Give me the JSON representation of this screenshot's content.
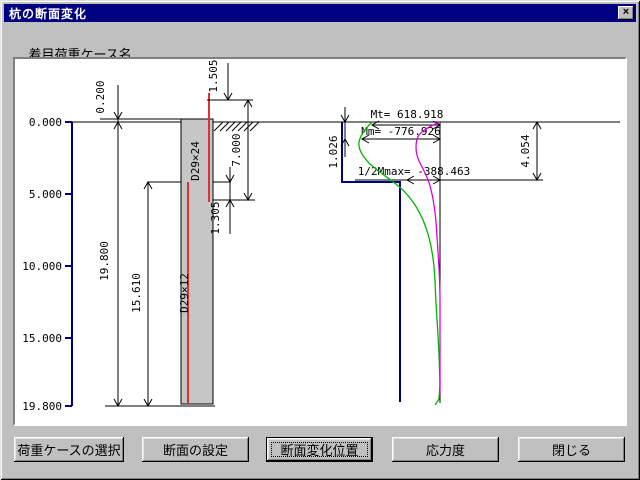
{
  "window": {
    "title": "杭の断面変化",
    "close_glyph": "×"
  },
  "header": {
    "case_label": "着目荷重ケース名",
    "direction": "橋軸方向",
    "case_name": "地震時(R)"
  },
  "drawing": {
    "axis_ticks": [
      "0.000",
      "5.000",
      "10.000",
      "15.000",
      "19.800"
    ],
    "pile": {
      "upper_rebar": "D29×24",
      "lower_rebar": "D29×12"
    },
    "dims": {
      "head_offset": "0.200",
      "pile_length": "19.800",
      "lower_length": "15.610",
      "top_height": "1.505",
      "upper_span": "7.000",
      "mid_span": "1.305",
      "mm_depth": "1.026",
      "half_mmax_depth": "4.054"
    },
    "moments": {
      "mt": "Mt= 618.918",
      "mm": "Mm= -776.926",
      "half_mmax": "1/2Mmax= -388.463"
    },
    "colors": {
      "axis_blue": "#000080",
      "rebar_red": "#e03030",
      "curve_green": "#00b400",
      "curve_magenta": "#e000e0"
    }
  },
  "buttons": [
    {
      "label": "荷重ケースの選択"
    },
    {
      "label": "断面の設定"
    },
    {
      "label": "断面変化位置"
    },
    {
      "label": "応力度"
    },
    {
      "label": "閉じる"
    }
  ]
}
